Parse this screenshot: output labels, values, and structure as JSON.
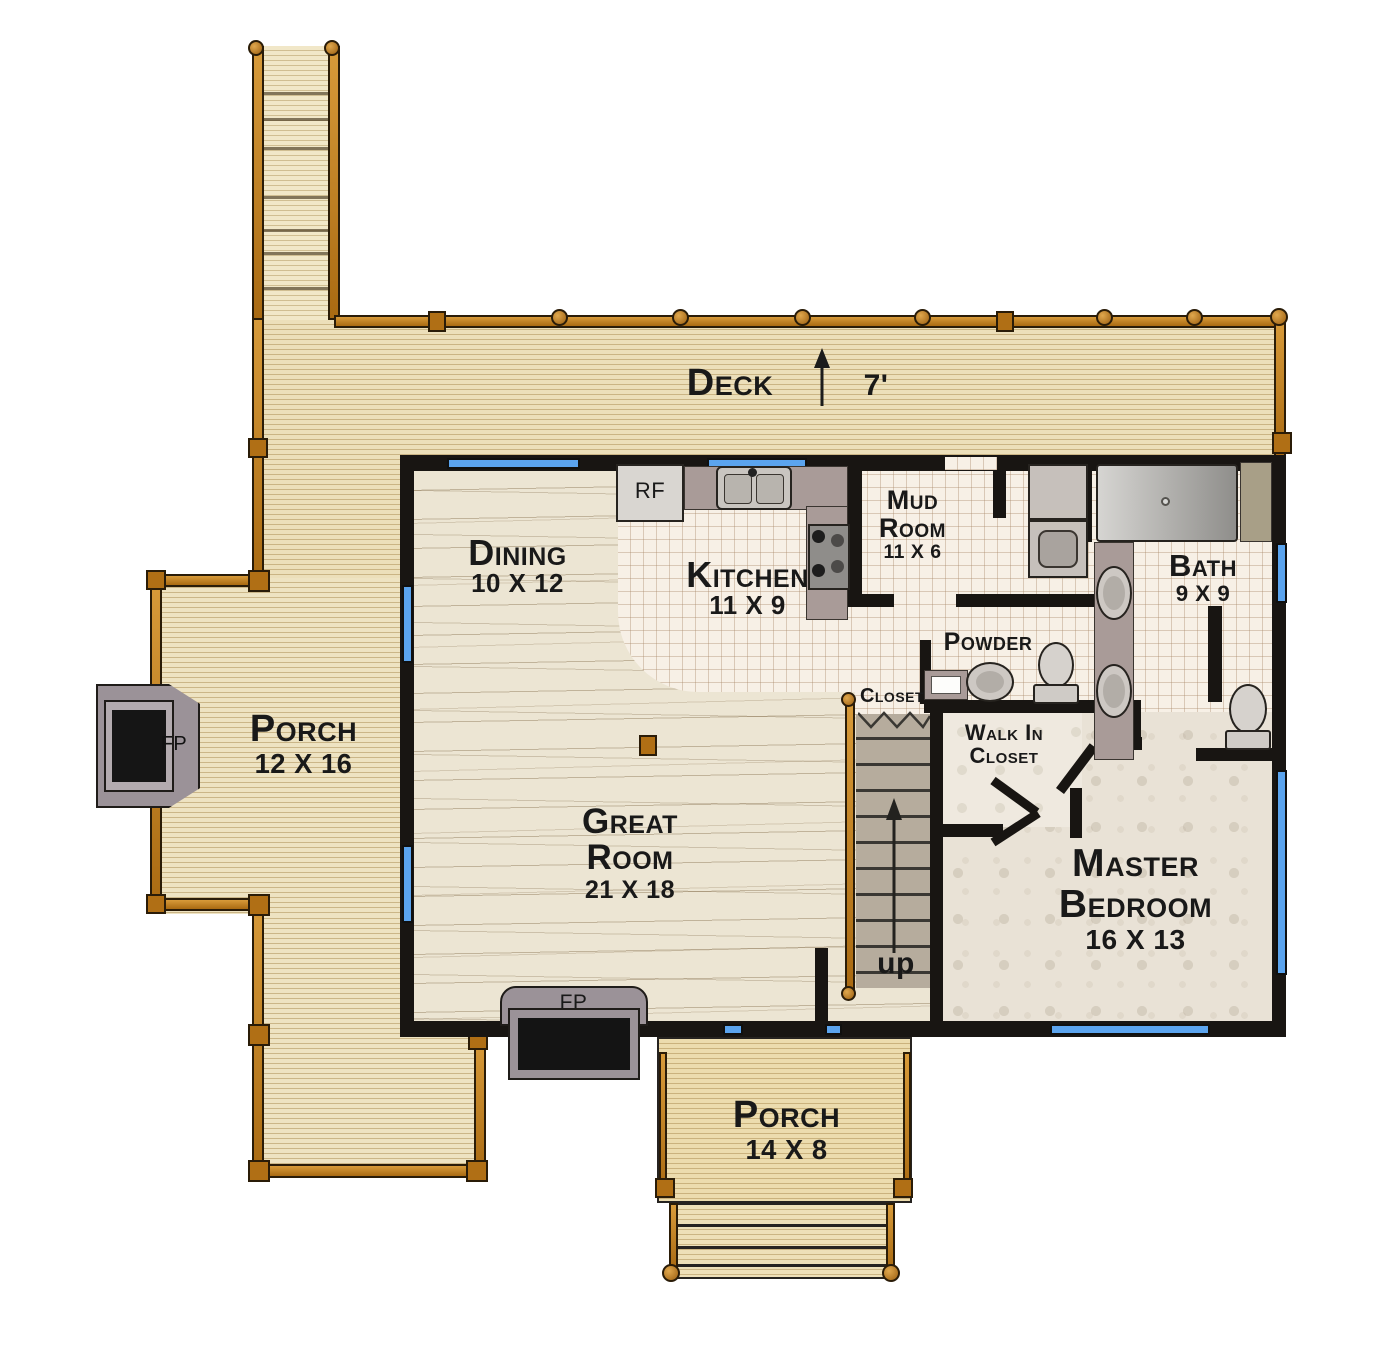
{
  "rooms": {
    "deck": {
      "name": "Deck",
      "depth": "7'"
    },
    "dining": {
      "name": "Dining",
      "dims": "10 X 12"
    },
    "kitchen": {
      "name": "Kitchen",
      "dims": "11 X 9"
    },
    "mud_room": {
      "name_line1": "Mud",
      "name_line2": "Room",
      "dims": "11 X 6"
    },
    "bath": {
      "name": "Bath",
      "dims": "9 X 9"
    },
    "powder": {
      "name": "Powder"
    },
    "closet": {
      "name": "Closet"
    },
    "walk_in": {
      "name_line1": "Walk In",
      "name_line2": "Closet"
    },
    "great_room": {
      "name_line1": "Great",
      "name_line2": "Room",
      "dims": "21 X 18"
    },
    "master": {
      "name_line1": "Master",
      "name_line2": "Bedroom",
      "dims": "16 X 13"
    },
    "side_porch": {
      "name": "Porch",
      "dims": "12 X 16"
    },
    "front_porch": {
      "name": "Porch",
      "dims": "14 X 8"
    }
  },
  "annotations": {
    "stairs_direction": "up",
    "great_room_fireplace": "FP",
    "porch_fireplace": "FP",
    "refrigerator": "RF"
  },
  "colors": {
    "wall": "#181512",
    "window_glass": "#5ba4ee",
    "railing_wood": "#c0801c",
    "deck_wood": "#ecdfba",
    "interior_wood": "#ece5d3",
    "tile": "#f7f0e6",
    "carpet": "#e9e2d6",
    "counter_gray": "#a99b98",
    "stair_tread": "#b6ac9d",
    "fireplace_gray": "#9b9298"
  }
}
